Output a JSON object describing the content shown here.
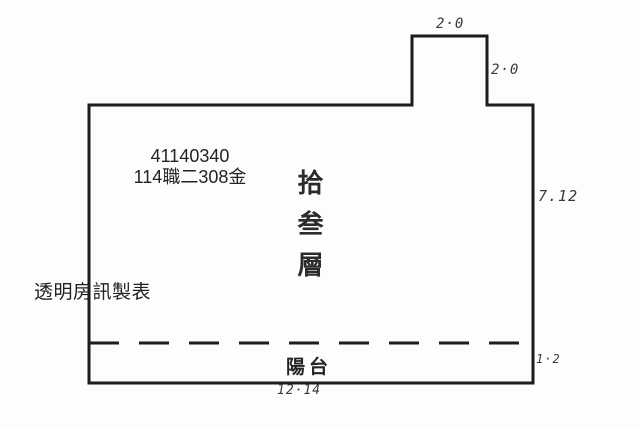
{
  "page": {
    "background": "#fdfdfc",
    "line_color": "#1c1c1c"
  },
  "plan": {
    "unit_code": "41140340",
    "unit_label": "114職二308金",
    "floor_label": "拾叁層",
    "balcony_label": "陽台",
    "watermark": "透明房訊製表",
    "dimensions": {
      "top_width": "2·0",
      "notch_height": "2·0",
      "right_height": "7.12",
      "balcony_height": "1·2",
      "bottom_width": "12·14"
    }
  }
}
